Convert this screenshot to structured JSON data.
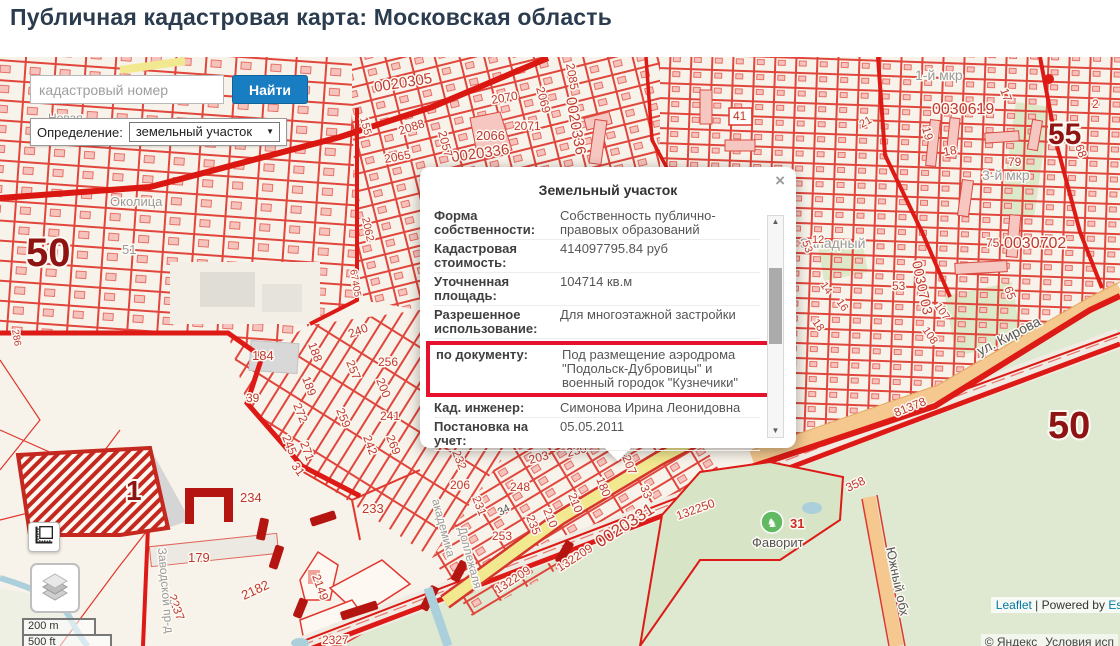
{
  "page": {
    "title": "Публичная кадастровая карта: Московская область"
  },
  "search": {
    "placeholder": "кадастровый номер",
    "button": "Найти"
  },
  "filter": {
    "label": "Определение:",
    "value": "земельный участок"
  },
  "popup": {
    "title": "Земельный участок",
    "close": "×",
    "rows": [
      {
        "label": "Форма собственности:",
        "value": "Собственность публично-правовых образований"
      },
      {
        "label": "Кадастровая стоимость:",
        "value": "414097795.84 руб"
      },
      {
        "label": "Уточненная площадь:",
        "value": "104714 кв.м"
      },
      {
        "label": "Разрешенное использование:",
        "value": "Для многоэтажной застройки"
      },
      {
        "label": "по документу:",
        "value": "Под размещение аэродрома \"Подольск-Дубровицы\" и военный городок \"Кузнечики\"",
        "highlight": true
      },
      {
        "label": "Кад. инженер:",
        "value": "Симонова Ирина Леонидовна"
      },
      {
        "label": "Постановка на учет:",
        "value": "05.05.2011"
      }
    ]
  },
  "scale": {
    "metric": "200 m",
    "imperial": "500 ft"
  },
  "attribution": {
    "leaflet": "Leaflet",
    "separator": " | Powered by ",
    "esri": "Esri",
    "yandex_copyright": "© Яндекс",
    "yandex_terms": "Условия исп"
  },
  "map": {
    "colors": {
      "parcel_line": "#e0463c",
      "boundary": "#dd1a15",
      "quarter_number": "#8e1413",
      "label_red": "#c0392f",
      "road_orange": "#f4c88e",
      "road_yellow": "#f2e88f",
      "green": "#dfe9d2",
      "water": "#abd0dc",
      "selected_accent": "#e8112d",
      "button_blue": "#187dc1"
    },
    "labels": [
      {
        "t": "0020305",
        "x": 375,
        "y": 92,
        "r": -9,
        "s": 15,
        "c": "n"
      },
      {
        "t": "0020336",
        "x": 566,
        "y": 98,
        "r": 80,
        "s": 15,
        "c": "n"
      },
      {
        "t": "0020336",
        "x": 452,
        "y": 162,
        "r": -8,
        "s": 15,
        "c": "n"
      },
      {
        "t": "2070",
        "x": 492,
        "y": 104,
        "r": -10,
        "s": 12,
        "c": "n"
      },
      {
        "t": "2069",
        "x": 536,
        "y": 88,
        "r": 75,
        "s": 12,
        "c": "n"
      },
      {
        "t": "2085",
        "x": 566,
        "y": 64,
        "r": 80,
        "s": 12,
        "c": "n"
      },
      {
        "t": "2071",
        "x": 514,
        "y": 130,
        "r": 0,
        "s": 12,
        "c": "n"
      },
      {
        "t": "2066",
        "x": 476,
        "y": 140,
        "r": 0,
        "s": 13,
        "c": "n"
      },
      {
        "t": "2057",
        "x": 438,
        "y": 132,
        "r": 75,
        "s": 12,
        "c": "n"
      },
      {
        "t": "2088",
        "x": 400,
        "y": 135,
        "r": -18,
        "s": 12,
        "c": "n"
      },
      {
        "t": "2065",
        "x": 385,
        "y": 163,
        "r": -10,
        "s": 12,
        "c": "n"
      },
      {
        "t": "155",
        "x": 360,
        "y": 118,
        "r": 75,
        "s": 11,
        "c": "n"
      },
      {
        "t": "2062",
        "x": 362,
        "y": 218,
        "r": 78,
        "s": 11,
        "c": "n"
      },
      {
        "t": "67405",
        "x": 350,
        "y": 270,
        "r": 80,
        "s": 10,
        "c": "n"
      },
      {
        "t": "50",
        "x": 26,
        "y": 266,
        "r": 0,
        "s": 40,
        "c": "b"
      },
      {
        "t": "51",
        "x": 122,
        "y": 254,
        "r": 0,
        "s": 13,
        "c": "g"
      },
      {
        "t": "Околица",
        "x": 110,
        "y": 206,
        "r": 0,
        "s": 13,
        "c": "g"
      },
      {
        "t": "Новая",
        "x": 48,
        "y": 122,
        "r": 0,
        "s": 12,
        "c": "g"
      },
      {
        "t": "286",
        "x": 12,
        "y": 330,
        "r": 80,
        "s": 10,
        "c": "n"
      },
      {
        "t": "184",
        "x": 252,
        "y": 360,
        "r": 0,
        "s": 13,
        "c": "n"
      },
      {
        "t": "188",
        "x": 308,
        "y": 344,
        "r": 70,
        "s": 12,
        "c": "n"
      },
      {
        "t": "189",
        "x": 302,
        "y": 378,
        "r": 70,
        "s": 12,
        "c": "n"
      },
      {
        "t": "39",
        "x": 246,
        "y": 402,
        "r": 0,
        "s": 12,
        "c": "n"
      },
      {
        "t": "272",
        "x": 293,
        "y": 405,
        "r": 68,
        "s": 12,
        "c": "n"
      },
      {
        "t": "245",
        "x": 282,
        "y": 437,
        "r": 68,
        "s": 12,
        "c": "n"
      },
      {
        "t": "240",
        "x": 350,
        "y": 338,
        "r": -20,
        "s": 12,
        "c": "n"
      },
      {
        "t": "256",
        "x": 378,
        "y": 366,
        "r": 0,
        "s": 12,
        "c": "n"
      },
      {
        "t": "257",
        "x": 346,
        "y": 362,
        "r": 68,
        "s": 12,
        "c": "n"
      },
      {
        "t": "200",
        "x": 376,
        "y": 380,
        "r": 68,
        "s": 12,
        "c": "n"
      },
      {
        "t": "241",
        "x": 380,
        "y": 420,
        "r": 0,
        "s": 12,
        "c": "n"
      },
      {
        "t": "259",
        "x": 336,
        "y": 410,
        "r": 68,
        "s": 12,
        "c": "n"
      },
      {
        "t": "242",
        "x": 363,
        "y": 437,
        "r": 70,
        "s": 12,
        "c": "n"
      },
      {
        "t": "269",
        "x": 386,
        "y": 437,
        "r": 68,
        "s": 12,
        "c": "n"
      },
      {
        "t": "271",
        "x": 300,
        "y": 443,
        "r": 70,
        "s": 12,
        "c": "n"
      },
      {
        "t": "1",
        "x": 126,
        "y": 500,
        "r": 0,
        "s": 28,
        "c": "b"
      },
      {
        "t": "234",
        "x": 240,
        "y": 502,
        "r": 0,
        "s": 13,
        "c": "n"
      },
      {
        "t": "233",
        "x": 362,
        "y": 513,
        "r": 0,
        "s": 13,
        "c": "n"
      },
      {
        "t": "31",
        "x": 291,
        "y": 466,
        "r": 55,
        "s": 12,
        "c": "n"
      },
      {
        "t": "179",
        "x": 188,
        "y": 562,
        "r": 0,
        "s": 13,
        "c": "n"
      },
      {
        "t": "2237",
        "x": 168,
        "y": 596,
        "r": 70,
        "s": 12,
        "c": "n"
      },
      {
        "t": "2182",
        "x": 244,
        "y": 600,
        "r": -25,
        "s": 13,
        "c": "n"
      },
      {
        "t": "2149",
        "x": 312,
        "y": 576,
        "r": 70,
        "s": 12,
        "c": "n"
      },
      {
        "t": "2327",
        "x": 322,
        "y": 644,
        "r": 0,
        "s": 12,
        "c": "n"
      },
      {
        "t": "Заводской пр-д",
        "x": 158,
        "y": 548,
        "r": 85,
        "s": 12,
        "c": "g"
      },
      {
        "t": "академика",
        "x": 432,
        "y": 500,
        "r": 75,
        "s": 12,
        "c": "g"
      },
      {
        "t": "Доллежаля",
        "x": 458,
        "y": 528,
        "r": 75,
        "s": 12,
        "c": "g"
      },
      {
        "t": "232",
        "x": 452,
        "y": 452,
        "r": 68,
        "s": 12,
        "c": "n"
      },
      {
        "t": "203",
        "x": 530,
        "y": 464,
        "r": -15,
        "s": 12,
        "c": "n"
      },
      {
        "t": "230",
        "x": 568,
        "y": 457,
        "r": -15,
        "s": 12,
        "c": "n"
      },
      {
        "t": "206",
        "x": 450,
        "y": 489,
        "r": 0,
        "s": 12,
        "c": "n"
      },
      {
        "t": "248",
        "x": 510,
        "y": 491,
        "r": 0,
        "s": 12,
        "c": "n"
      },
      {
        "t": "231",
        "x": 472,
        "y": 498,
        "r": 68,
        "s": 12,
        "c": "n"
      },
      {
        "t": "34",
        "x": 500,
        "y": 516,
        "r": -28,
        "s": 11,
        "c": "d"
      },
      {
        "t": "210",
        "x": 543,
        "y": 510,
        "r": 68,
        "s": 12,
        "c": "n"
      },
      {
        "t": "210",
        "x": 568,
        "y": 495,
        "r": 68,
        "s": 12,
        "c": "n"
      },
      {
        "t": "235",
        "x": 526,
        "y": 517,
        "r": 68,
        "s": 12,
        "c": "n"
      },
      {
        "t": "253",
        "x": 492,
        "y": 540,
        "r": 0,
        "s": 12,
        "c": "n"
      },
      {
        "t": "207",
        "x": 622,
        "y": 457,
        "r": 68,
        "s": 12,
        "c": "n"
      },
      {
        "t": "180",
        "x": 596,
        "y": 479,
        "r": 68,
        "s": 12,
        "c": "n"
      },
      {
        "t": "33",
        "x": 640,
        "y": 487,
        "r": 68,
        "s": 12,
        "c": "n"
      },
      {
        "t": "0020331",
        "x": 600,
        "y": 548,
        "r": -33,
        "s": 17,
        "c": "n"
      },
      {
        "t": "132209",
        "x": 560,
        "y": 572,
        "r": -33,
        "s": 12,
        "c": "n"
      },
      {
        "t": "132209",
        "x": 498,
        "y": 594,
        "r": -33,
        "s": 12,
        "c": "n"
      },
      {
        "t": "132250",
        "x": 678,
        "y": 520,
        "r": -20,
        "s": 12,
        "c": "n"
      },
      {
        "t": "358",
        "x": 848,
        "y": 492,
        "r": -25,
        "s": 12,
        "c": "n"
      },
      {
        "t": "81378",
        "x": 896,
        "y": 417,
        "r": -22,
        "s": 12,
        "c": "n"
      },
      {
        "t": "Южный обх",
        "x": 886,
        "y": 548,
        "r": 78,
        "s": 13,
        "c": "d"
      },
      {
        "t": "Фаворит",
        "x": 752,
        "y": 547,
        "r": 0,
        "s": 13,
        "c": "d"
      },
      {
        "t": "31",
        "x": 790,
        "y": 528,
        "r": 0,
        "s": 13,
        "c": "rb"
      },
      {
        "t": "1-й мкр",
        "x": 915,
        "y": 80,
        "r": 0,
        "s": 14,
        "c": "g"
      },
      {
        "t": "0030619",
        "x": 932,
        "y": 114,
        "r": 0,
        "s": 16,
        "c": "n"
      },
      {
        "t": "55",
        "x": 1048,
        "y": 144,
        "r": 0,
        "s": 30,
        "c": "b"
      },
      {
        "t": "2",
        "x": 1092,
        "y": 108,
        "r": 0,
        "s": 12,
        "c": "n"
      },
      {
        "t": "17",
        "x": 1000,
        "y": 90,
        "r": 70,
        "s": 12,
        "c": "n"
      },
      {
        "t": "19",
        "x": 922,
        "y": 128,
        "r": 75,
        "s": 12,
        "c": "n"
      },
      {
        "t": "18",
        "x": 944,
        "y": 156,
        "r": -10,
        "s": 12,
        "c": "n"
      },
      {
        "t": "79",
        "x": 1008,
        "y": 166,
        "r": 0,
        "s": 12,
        "c": "n"
      },
      {
        "t": "68",
        "x": 1075,
        "y": 146,
        "r": 70,
        "s": 12,
        "c": "n"
      },
      {
        "t": "21",
        "x": 862,
        "y": 128,
        "r": -30,
        "s": 11,
        "c": "n"
      },
      {
        "t": "3-й мкр",
        "x": 982,
        "y": 180,
        "r": 0,
        "s": 14,
        "c": "g"
      },
      {
        "t": "Западный",
        "x": 800,
        "y": 248,
        "r": 0,
        "s": 14,
        "c": "g"
      },
      {
        "t": "12",
        "x": 812,
        "y": 243,
        "r": 0,
        "s": 11,
        "c": "n"
      },
      {
        "t": "75",
        "x": 986,
        "y": 247,
        "r": 0,
        "s": 12,
        "c": "n"
      },
      {
        "t": "0030702",
        "x": 1004,
        "y": 248,
        "r": 0,
        "s": 16,
        "c": "n"
      },
      {
        "t": "0030703",
        "x": 912,
        "y": 262,
        "r": 78,
        "s": 14,
        "c": "n"
      },
      {
        "t": "53",
        "x": 892,
        "y": 290,
        "r": 0,
        "s": 12,
        "c": "n"
      },
      {
        "t": "53",
        "x": 802,
        "y": 242,
        "r": 70,
        "s": 11,
        "c": "n"
      },
      {
        "t": "14",
        "x": 820,
        "y": 285,
        "r": 55,
        "s": 11,
        "c": "n"
      },
      {
        "t": "16",
        "x": 836,
        "y": 302,
        "r": 55,
        "s": 11,
        "c": "n"
      },
      {
        "t": "18",
        "x": 812,
        "y": 322,
        "r": 55,
        "s": 11,
        "c": "n"
      },
      {
        "t": "65",
        "x": 1004,
        "y": 288,
        "r": 70,
        "s": 12,
        "c": "n"
      },
      {
        "t": "107",
        "x": 934,
        "y": 306,
        "r": 55,
        "s": 11,
        "c": "n"
      },
      {
        "t": "108",
        "x": 922,
        "y": 330,
        "r": 55,
        "s": 11,
        "c": "n"
      },
      {
        "t": "ул. Кирова",
        "x": 980,
        "y": 356,
        "r": -27,
        "s": 14,
        "c": "d"
      },
      {
        "t": "50",
        "x": 1048,
        "y": 438,
        "r": 0,
        "s": 38,
        "c": "b"
      },
      {
        "t": "41",
        "x": 733,
        "y": 120,
        "r": 0,
        "s": 12,
        "c": "n",
        "box": true
      }
    ]
  }
}
